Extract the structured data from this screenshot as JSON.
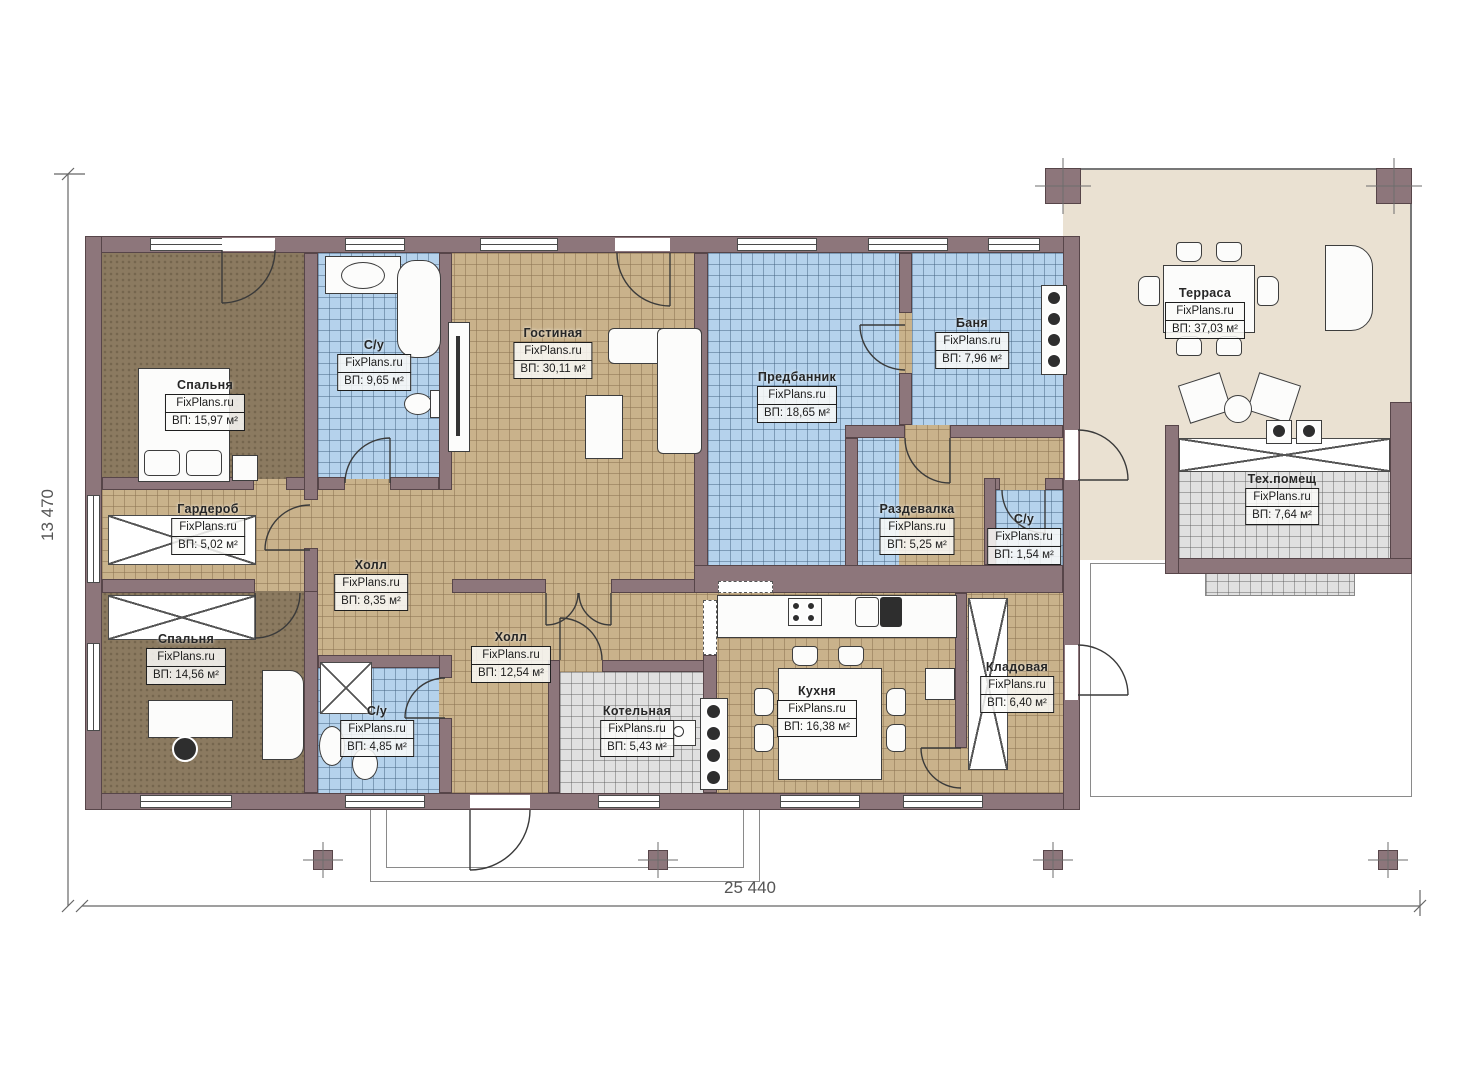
{
  "brand": "FixPlans.ru",
  "dimensions": {
    "width": "25 440",
    "height": "13 470"
  },
  "rooms": [
    {
      "name": "Спальня",
      "area": "ВП: 15,97 м²"
    },
    {
      "name": "С/у",
      "area": "ВП: 9,65 м²"
    },
    {
      "name": "Гостиная",
      "area": "ВП: 30,11 м²"
    },
    {
      "name": "Предбанник",
      "area": "ВП: 18,65 м²"
    },
    {
      "name": "Баня",
      "area": "ВП: 7,96 м²"
    },
    {
      "name": "Терраса",
      "area": "ВП: 37,03 м²"
    },
    {
      "name": "Гардероб",
      "area": "ВП: 5,02 м²"
    },
    {
      "name": "Холл",
      "area": "ВП: 8,35 м²"
    },
    {
      "name": "Раздевалка",
      "area": "ВП: 5,25 м²"
    },
    {
      "name": "С/у",
      "area": "ВП: 1,54 м²"
    },
    {
      "name": "Тех.помещ",
      "area": "ВП: 7,64 м²"
    },
    {
      "name": "Спальня",
      "area": "ВП: 14,56 м²"
    },
    {
      "name": "С/у",
      "area": "ВП: 4,85 м²"
    },
    {
      "name": "Холл",
      "area": "ВП: 12,54 м²"
    },
    {
      "name": "Котельная",
      "area": "ВП: 5,43 м²"
    },
    {
      "name": "Кухня",
      "area": "ВП: 16,38 м²"
    },
    {
      "name": "Кладовая",
      "area": "ВП: 6,40 м²"
    }
  ],
  "colors": {
    "wall": "#8d767b",
    "wall_edge": "#574549",
    "floor_tan": "#c9b28b",
    "floor_blue": "#b5d2ec",
    "floor_gray": "#e0e0e0",
    "floor_bedroom": "#8b7a60",
    "floor_terrace": "#eae1d2"
  }
}
